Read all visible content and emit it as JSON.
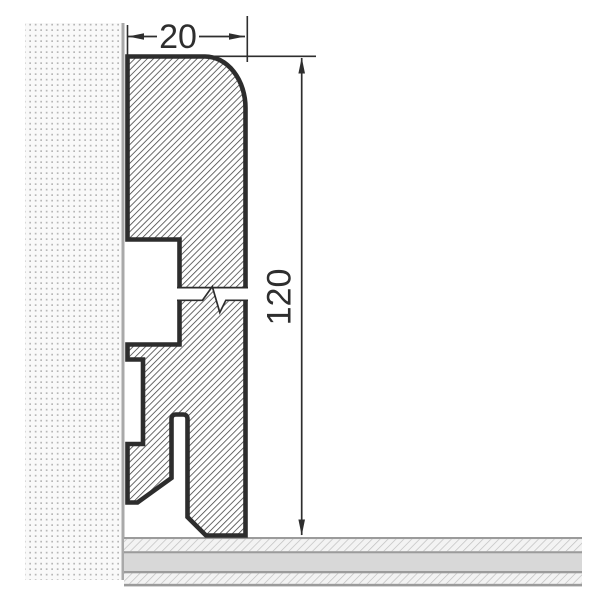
{
  "figure": {
    "description": "Cross-section drawing of a skirting board profile on a wall above a floor",
    "width_dimension": "20",
    "height_dimension": "120"
  },
  "colors": {
    "outline": "#2d2d2d",
    "profile_hatch": "#3f3f3f",
    "dimension": "#2e2e2e",
    "wall_dot": "#b7b7b7",
    "wall_background": "#f9f9f9",
    "wall_surface_line": "#a9a9a9",
    "floor_line": "#9b9b9b",
    "floor_fill": "#d8d8d8",
    "floor_hatch_line": "#c0c0c0",
    "floor_hatch_background": "#f3f3f3"
  }
}
